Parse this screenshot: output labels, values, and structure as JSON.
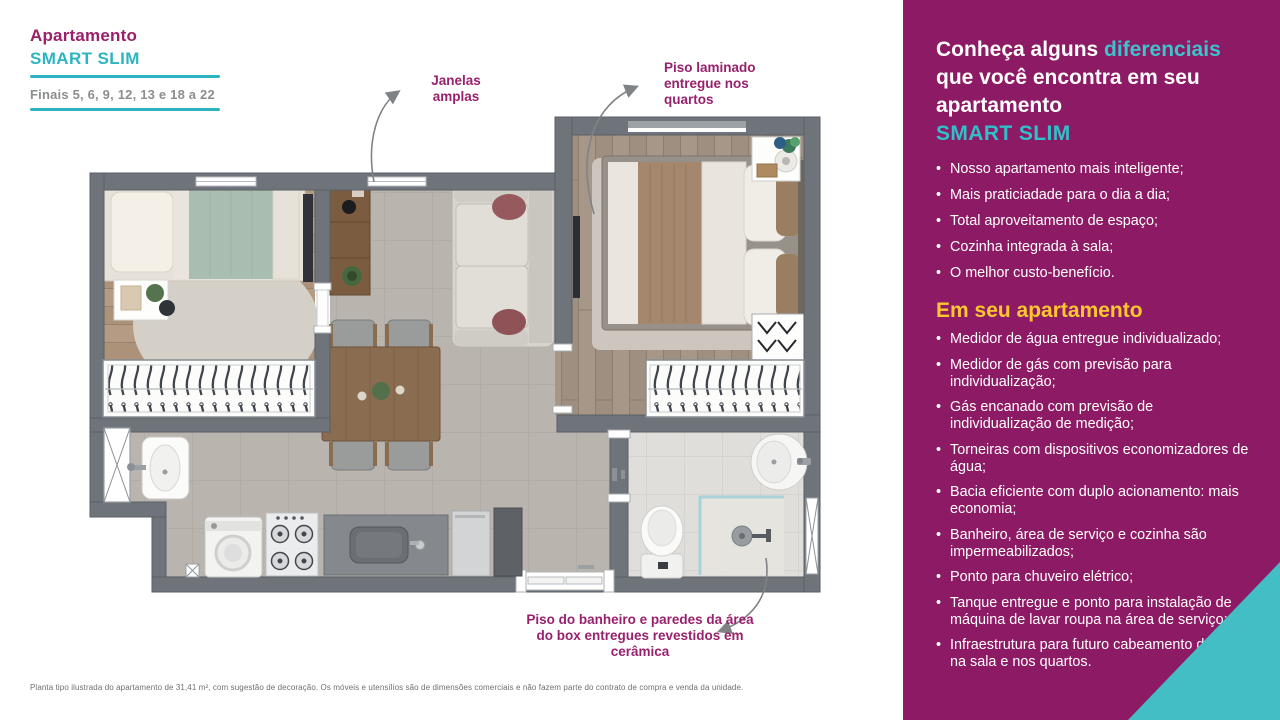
{
  "header": {
    "kicker": "Apartamento",
    "title": "SMART SLIM",
    "subtitle": "Finais 5, 6, 9, 12, 13 e 18 a 22"
  },
  "callouts": {
    "windows": "Janelas amplas",
    "laminate": "Piso laminado entregue nos quartos",
    "bathroom": "Piso do banheiro e paredes da área do box entregues revestidos em cerâmica"
  },
  "sidebar": {
    "heading": {
      "part1": "Conheça alguns ",
      "highlight": "diferenciais",
      "line2": "que você encontra em seu",
      "line3": "apartamento",
      "brand": "SMART SLIM"
    },
    "differentials": [
      "Nosso apartamento mais inteligente;",
      "Mais praticiadade para o dia a dia;",
      "Total aproveitamento de espaço;",
      "Cozinha integrada à sala;",
      "O melhor custo-benefício."
    ],
    "section2_title": "Em seu apartamento",
    "apartment_features": [
      "Medidor de água entregue individualizado;",
      "Medidor de gás com previsão para individualização;",
      "Gás encanado com previsão de individualização de medição;",
      "Torneiras com dispositivos economizadores de água;",
      "Bacia eficiente com duplo acionamento: mais economia;",
      "Banheiro, área de serviço e cozinha são impermeabilizados;",
      "Ponto para chuveiro elétrico;",
      "Tanque entregue e ponto para instalação de máquina de lavar roupa na área de serviço;",
      "Infraestrutura para futuro cabeamento de TV na sala e nos quartos."
    ]
  },
  "disclaimer": "Planta tipo ilustrada do apartamento de 31,41 m², com sugestão de decoração. Os móveis e utensílios são de dimensões comerciais e não fazem parte do contrato de compra e venda da unidade.",
  "colors": {
    "sidebar_magenta": "#8d1a64",
    "accent_teal": "#2cb5c0",
    "accent_yellow": "#ffc72f",
    "title_magenta": "#9b2069",
    "wall_gray": "#6f747a"
  }
}
